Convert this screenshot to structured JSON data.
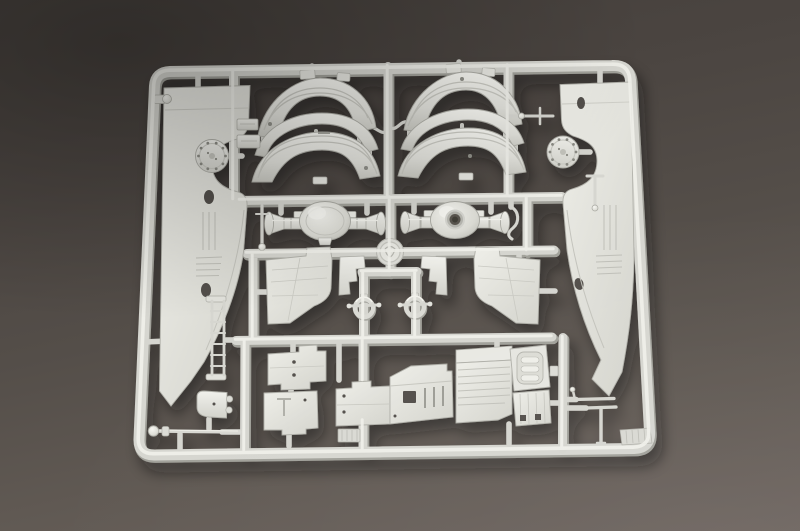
{
  "scene": {
    "description": "Photograph of an unpainted light-gray injection-molded plastic model-kit sprue (parts tree) for a military truck kit, lying on a dark warm-gray surface",
    "background_top": "#433e3a",
    "background_bottom": "#6e6560",
    "plastic_base": "#d6d6d0",
    "plastic_highlight": "#f1f1eb",
    "plastic_shadow": "#a7a7a0"
  },
  "parts": {
    "frame": {
      "label": "sprue outer frame runner"
    },
    "runners": {
      "label": "internal runner grid"
    },
    "medallion": {
      "label": "round embossed manufacturer medallion at runner crossing"
    },
    "left_side_panel": {
      "label": "left fender side-skirt panel with oval holes and ribbed recess"
    },
    "right_side_panel": {
      "label": "right fender side-skirt panel with teardrop hole and ribbed recess"
    },
    "left_hub_flange": {
      "label": "circular hub flange with bolt holes, left"
    },
    "right_hub_flange": {
      "label": "circular hub flange with bolt holes, right"
    },
    "left_fender_pair": {
      "label": "pair of curved mudguards with tread grooves, left"
    },
    "right_fender_pair": {
      "label": "pair of curved mudguards with tread grooves, right"
    },
    "left_axle": {
      "label": "axle with domed differential housing"
    },
    "right_axle": {
      "label": "axle with open-hub differential housing"
    },
    "lever_rod": {
      "label": "small lever rod with ball end"
    },
    "hook_rod": {
      "label": "small S-hook rod"
    },
    "tee_rod_upper": {
      "label": "small tee-shaped rod, upper right"
    },
    "tee_rod_right": {
      "label": "small tee-shaped rod beside right panel"
    },
    "small_boxes": {
      "label": "two small block parts on left vertical runner"
    },
    "frame_lug": {
      "label": "small round lug on left frame rail"
    },
    "left_trapezoid_panel": {
      "label": "flat mudflap panel, left"
    },
    "right_trapezoid_panel": {
      "label": "flat mudflap panel, right"
    },
    "stepped_bracket_left": {
      "label": "stepped bracket, left"
    },
    "stepped_bracket_right": {
      "label": "stepped bracket, right"
    },
    "shackle_left": {
      "label": "towing shackle ring with pin, left"
    },
    "shackle_right": {
      "label": "towing shackle ring with pin, right"
    },
    "ladder_strip": {
      "label": "ladder-shaped strip part"
    },
    "stepped_plate_upper": {
      "label": "stepped flat plate with two holes"
    },
    "stepped_plate_lower": {
      "label": "stepped flat plate with engraved tee"
    },
    "chassis_floor": {
      "label": "long chassis floor plate with openings"
    },
    "cab_assembly": {
      "label": "cab floor and grille panel assembly"
    },
    "ball_end_rod": {
      "label": "long rod with ball end, bottom left"
    },
    "corner_bracket": {
      "label": "small rounded bracket with lugs"
    },
    "tee_rods_bottom_right": {
      "label": "two small tee rods, bottom right"
    },
    "hatched_tab_left": {
      "label": "small hatched tab on bottom frame, left"
    },
    "hatched_tab_right": {
      "label": "small hatched tab on bottom frame corner, right"
    }
  }
}
